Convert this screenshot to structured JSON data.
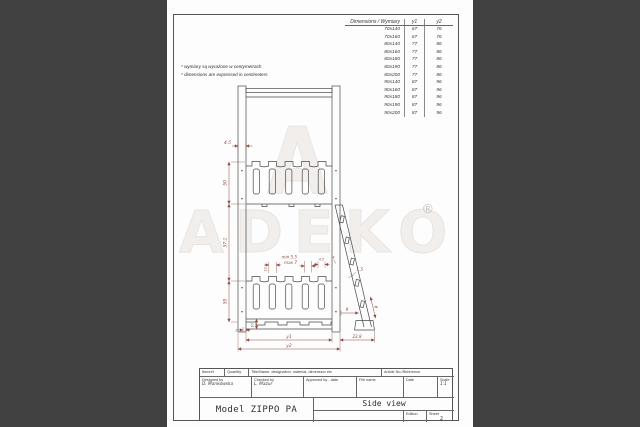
{
  "colors": {
    "background": "#414141",
    "sheet": "#fdfdfd",
    "line": "#4a4a4a",
    "dimension": "#8d4a43",
    "watermark": "#ece8e5"
  },
  "notes": {
    "line1": "* wymiary są wyrażone w centymetrach",
    "line2": "* dimensions are expressed in centimeters"
  },
  "size_table": {
    "header": {
      "dimensions": "Dimensions / Wymiary",
      "y1": "y1",
      "y2": "y2"
    },
    "rows": [
      {
        "dim": "70x140",
        "y1": "67",
        "y2": "76"
      },
      {
        "dim": "70x160",
        "y1": "67",
        "y2": "76"
      },
      {
        "dim": "80x140",
        "y1": "77",
        "y2": "86"
      },
      {
        "dim": "80x160",
        "y1": "77",
        "y2": "86"
      },
      {
        "dim": "80x180",
        "y1": "77",
        "y2": "86"
      },
      {
        "dim": "80x190",
        "y1": "77",
        "y2": "86"
      },
      {
        "dim": "80x200",
        "y1": "77",
        "y2": "86"
      },
      {
        "dim": "90x140",
        "y1": "87",
        "y2": "96"
      },
      {
        "dim": "90x160",
        "y1": "87",
        "y2": "96"
      },
      {
        "dim": "90x180",
        "y1": "87",
        "y2": "96"
      },
      {
        "dim": "90x190",
        "y1": "87",
        "y2": "96"
      },
      {
        "dim": "90x200",
        "y1": "87",
        "y2": "96"
      }
    ]
  },
  "drawing": {
    "dimensions": {
      "post_width": "4.5",
      "upper_guard_height": "50",
      "middle_height": "57.1",
      "lower_guard_height": "50",
      "slat_gap_min": "min 5.5",
      "slat_gap_max": "max 7",
      "slat_pitch": "12",
      "slat_width": "4.5",
      "end_gap": "4",
      "rung_thickness": "1.5",
      "ladder_base_offset": "9",
      "rung_spacing": "9",
      "base_lip": "2",
      "base_height": "10",
      "ladder_reach": "23.8",
      "length_inner": "y1",
      "length_outer": "y2"
    },
    "watermark": {
      "logo_letter": "A",
      "brand": "ADEKO",
      "registered": "®"
    }
  },
  "title_block": {
    "itemref": "Itemref",
    "quantity": "Quantity",
    "title_name": "Title/Name, designation, material, dimension etc",
    "article": "Article No./Reference",
    "designed_by": {
      "label": "Designed by",
      "value": "D. Mankowska"
    },
    "checked_by": {
      "label": "Checked by",
      "value": "L. Mazur"
    },
    "approved_by": {
      "label": "Approved by - date",
      "value": ""
    },
    "file_name": {
      "label": "File name",
      "value": ""
    },
    "date": {
      "label": "Date",
      "value": ""
    },
    "scale": {
      "label": "Scale",
      "value": "1:1"
    },
    "model": "Model ZIPPO PA",
    "view": "Side view",
    "edition": {
      "label": "Edition",
      "value": ""
    },
    "sheet": {
      "label": "Sheet",
      "value": "2"
    }
  }
}
